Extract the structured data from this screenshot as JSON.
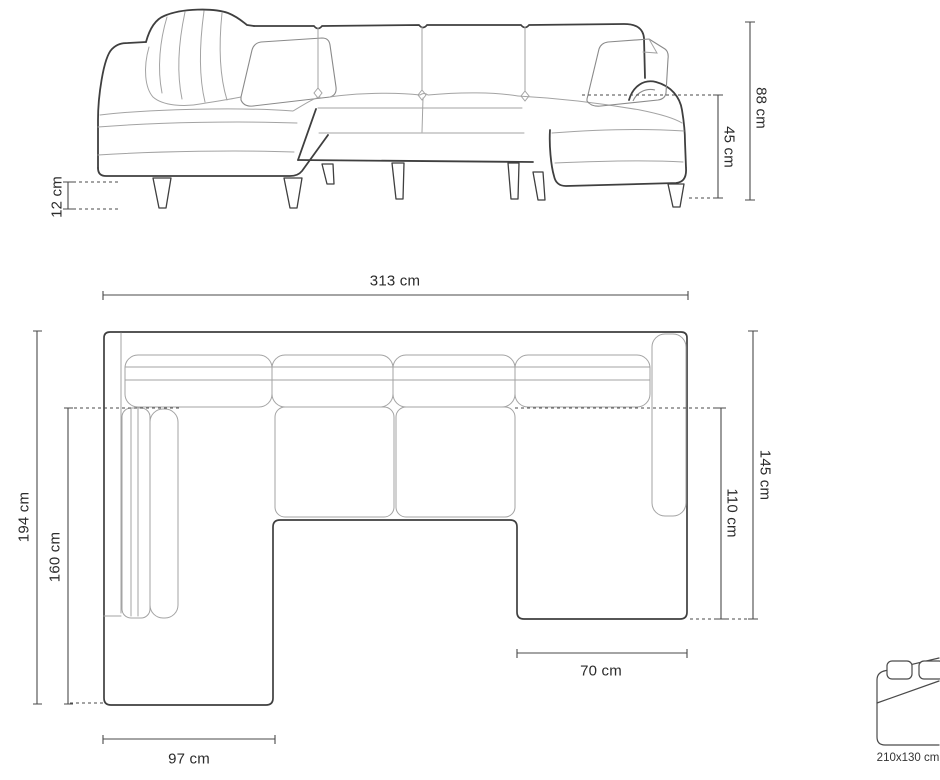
{
  "colors": {
    "background": "#ffffff",
    "line_dark": "#3f3f3f",
    "line_light": "#a3a3a3",
    "dimension_line": "#4a4a4a",
    "text": "#2b2b2b"
  },
  "elevation_view": {
    "dimensions": {
      "total_height": "88 cm",
      "seat_height": "45 cm",
      "leg_height": "12 cm"
    }
  },
  "plan_view": {
    "dimensions": {
      "total_width": "313 cm",
      "total_depth": "194 cm",
      "left_chaise_depth": "160 cm",
      "right_depth": "145 cm",
      "right_inner_depth": "110 cm",
      "left_chaise_width": "97 cm",
      "right_chaise_width": "70 cm"
    }
  },
  "sleeping_area": {
    "icon": "sofa-bed-icon",
    "size": "210x130 cm"
  }
}
